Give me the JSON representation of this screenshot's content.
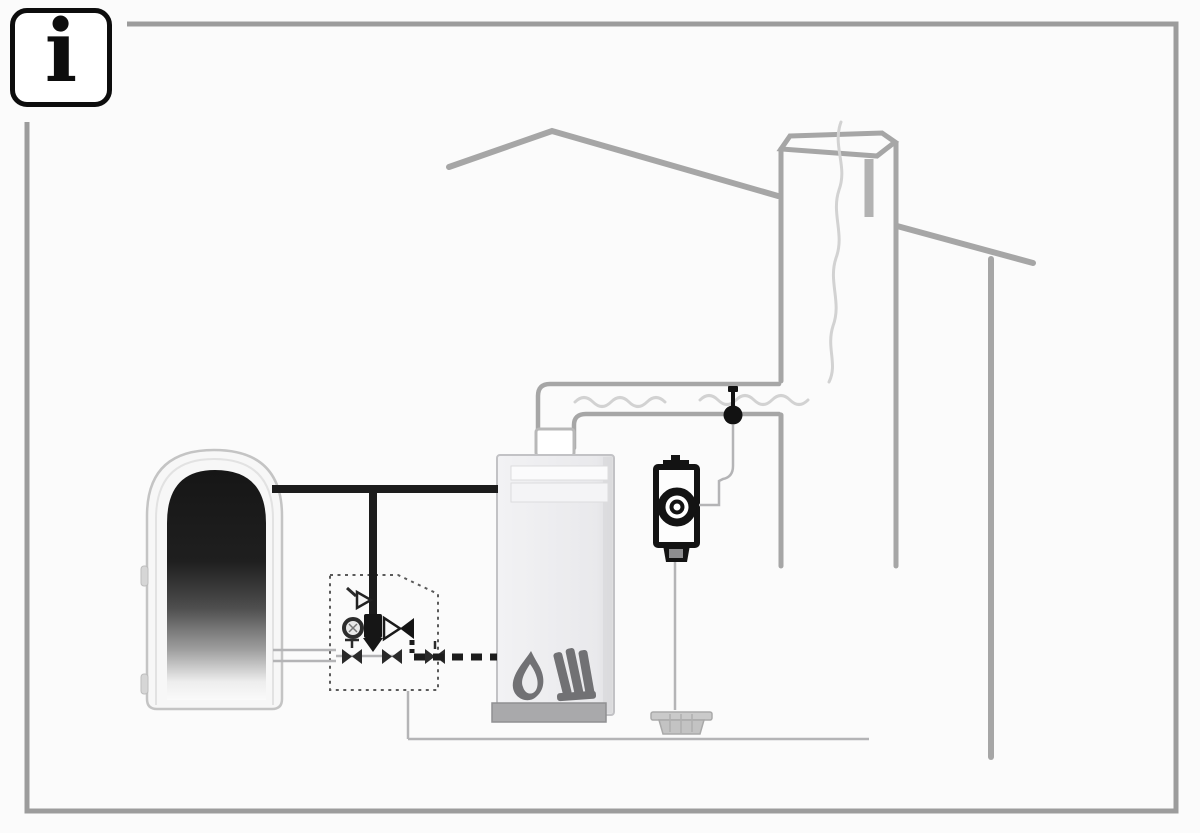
{
  "info_badge": {
    "glyph": "i"
  },
  "colors": {
    "background": "#fbfbfb",
    "frame": "#9c9c9c",
    "structure": "#a6a6a6",
    "smoke": "#d2d2d2",
    "pipe_dark": "#1c1c1c",
    "pipe_light": "#b4b4b6",
    "component_dark": "#131313",
    "icon_gray": "#717174"
  },
  "diagram": {
    "kind": "heating-system-installation-schematic",
    "components": [
      {
        "id": "storage-tank",
        "name": "hot-water-storage-tank-cutaway"
      },
      {
        "id": "boiler",
        "name": "solid-fuel-boiler"
      },
      {
        "id": "valve-group",
        "name": "pump-valve-group-dashed-boundary"
      },
      {
        "id": "thermal-discharge-pump",
        "name": "pump-with-safety-valve"
      },
      {
        "id": "flue-sensor",
        "name": "flue-gas-sensor"
      },
      {
        "id": "flue-pipe",
        "name": "flue-pipe-with-smoke"
      },
      {
        "id": "chimney",
        "name": "chimney"
      },
      {
        "id": "roof",
        "name": "roof-and-wall-outline"
      },
      {
        "id": "floor-drain",
        "name": "floor-drain"
      }
    ]
  }
}
